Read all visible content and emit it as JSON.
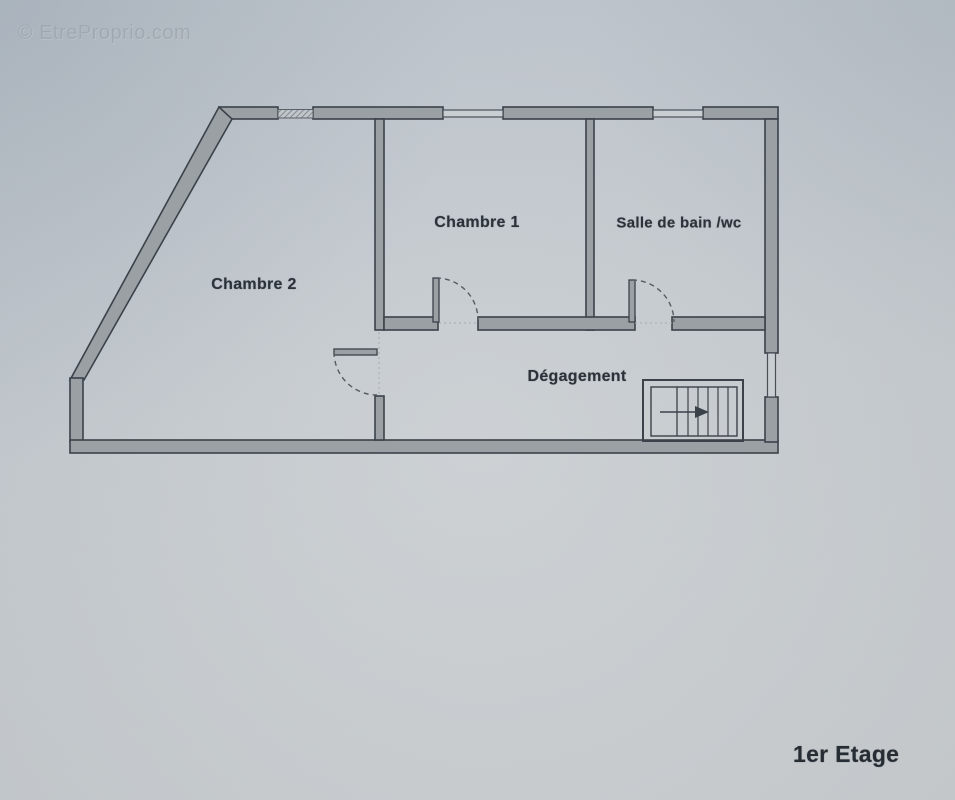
{
  "watermark": {
    "text": "© EtreProprio.com"
  },
  "floor": {
    "label": "1er Etage"
  },
  "rooms": {
    "chambre1": {
      "label": "Chambre 1"
    },
    "chambre2": {
      "label": "Chambre 2"
    },
    "salle_de_bain": {
      "label": "Salle de bain /wc"
    },
    "degagement": {
      "label": "Dégagement"
    }
  },
  "plan": {
    "elements": {
      "windows": [
        "window-chambre2-top-hatched",
        "window-chambre1-top",
        "window-salle-de-bain-top",
        "window-degagement-right"
      ],
      "doors": [
        "door-chambre1-swing",
        "door-salle-de-bain-swing",
        "door-chambre2-swing"
      ],
      "stairs": "staircase-with-right-arrow"
    },
    "colors": {
      "paper": "#c9ced2",
      "wall_fill": "#9aa0a4",
      "wall_outline": "#3c424a",
      "label_text": "#2c3239",
      "watermark_text": "#969fa8"
    }
  }
}
